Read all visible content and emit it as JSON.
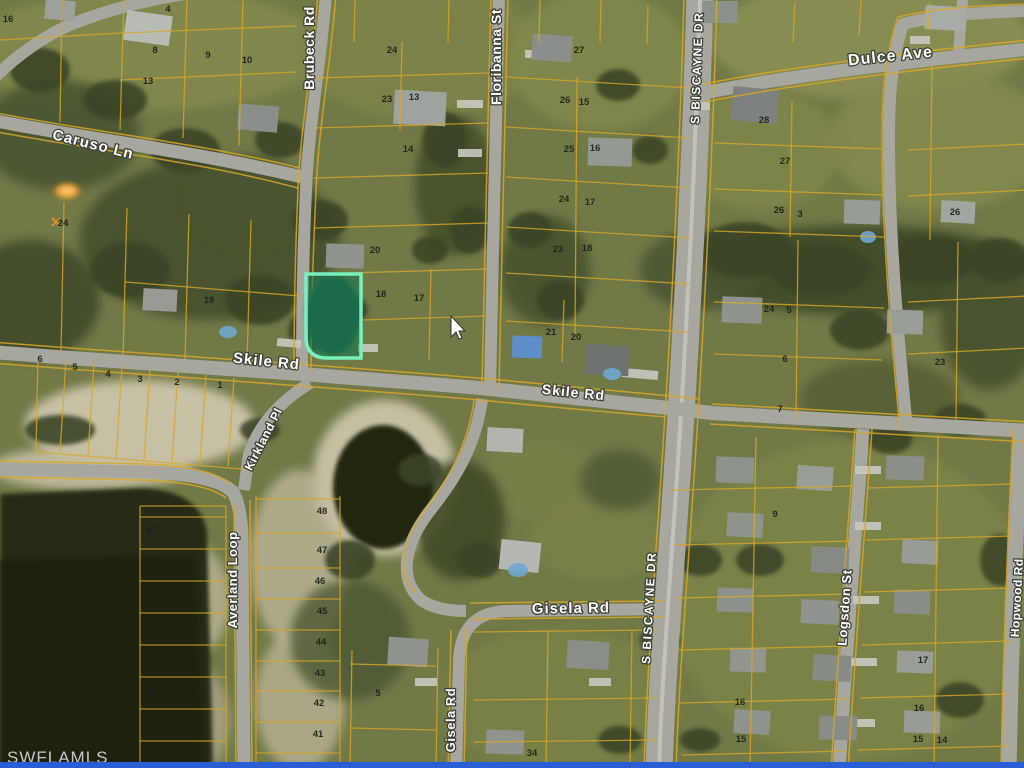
{
  "map": {
    "watermark": "SWFLAMLS",
    "colors": {
      "highlight_border": "#79efbe",
      "highlight_fill": "#0e7a52",
      "parcel_line": "#d8a728",
      "road": "#a7a7a0",
      "bottom_bar": "#2b5dd7",
      "water": "#262b13",
      "tarp_roof": "#5e8fc9"
    },
    "highlighted_parcel": {
      "label": "highlighted-lot",
      "street": "Skile Rd"
    },
    "streets": [
      {
        "id": "caruso-ln",
        "name": "Caruso Ln",
        "x": 92,
        "y": 149,
        "rot": 14,
        "size": 15,
        "ls": 1
      },
      {
        "id": "brubeck-rd",
        "name": "Brubeck Rd",
        "x": 314,
        "y": 48,
        "rot": -90,
        "size": 14,
        "ls": 0.5
      },
      {
        "id": "floribanna-st",
        "name": "Floribanna St",
        "x": 501,
        "y": 57,
        "rot": -90,
        "size": 14,
        "ls": 0.5
      },
      {
        "id": "s-biscayne-dr-n",
        "name": "S BISCAYNE DR",
        "x": 701,
        "y": 68,
        "rot": -88,
        "size": 12,
        "ls": 1.5
      },
      {
        "id": "dulce-ave",
        "name": "Dulce Ave",
        "x": 891,
        "y": 61,
        "rot": -6,
        "size": 16,
        "ls": 1
      },
      {
        "id": "skile-rd-w",
        "name": "Skile Rd",
        "x": 266,
        "y": 366,
        "rot": 6,
        "size": 15,
        "ls": 1
      },
      {
        "id": "skile-rd-e",
        "name": "Skile Rd",
        "x": 573,
        "y": 397,
        "rot": 6,
        "size": 14,
        "ls": 1
      },
      {
        "id": "kirkland-pl",
        "name": "Kirkland Pl",
        "x": 267,
        "y": 441,
        "rot": -63,
        "size": 12,
        "ls": 0.5
      },
      {
        "id": "averland-loop",
        "name": "Averland Loop",
        "x": 237,
        "y": 580,
        "rot": -90,
        "size": 13,
        "ls": 0.5
      },
      {
        "id": "s-biscayne-dr-s",
        "name": "S BISCAYNE DR",
        "x": 653,
        "y": 608,
        "rot": -87,
        "size": 12,
        "ls": 1.5
      },
      {
        "id": "gisela-rd-e",
        "name": "Gisela Rd",
        "x": 571,
        "y": 613,
        "rot": -1,
        "size": 15,
        "ls": 1
      },
      {
        "id": "gisela-rd-s",
        "name": "Gisela Rd",
        "x": 455,
        "y": 720,
        "rot": -90,
        "size": 13,
        "ls": 0.5
      },
      {
        "id": "logsdon-st",
        "name": "Logsdon St",
        "x": 849,
        "y": 608,
        "rot": -86,
        "size": 13,
        "ls": 0.5
      },
      {
        "id": "hopwood-rd",
        "name": "Hopwood Rd",
        "x": 1021,
        "y": 598,
        "rot": -87,
        "size": 12,
        "ls": 0.5
      }
    ],
    "lots": [
      {
        "n": "16",
        "x": 8,
        "y": 22
      },
      {
        "n": "4",
        "x": 168,
        "y": 12
      },
      {
        "n": "8",
        "x": 155,
        "y": 53
      },
      {
        "n": "9",
        "x": 208,
        "y": 58
      },
      {
        "n": "10",
        "x": 247,
        "y": 63
      },
      {
        "n": "13",
        "x": 148,
        "y": 84
      },
      {
        "n": "24",
        "x": 63,
        "y": 226
      },
      {
        "n": "19",
        "x": 209,
        "y": 303
      },
      {
        "n": "24",
        "x": 392,
        "y": 53
      },
      {
        "n": "23",
        "x": 387,
        "y": 102
      },
      {
        "n": "13",
        "x": 414,
        "y": 100
      },
      {
        "n": "14",
        "x": 408,
        "y": 152
      },
      {
        "n": "20",
        "x": 375,
        "y": 253
      },
      {
        "n": "18",
        "x": 381,
        "y": 297
      },
      {
        "n": "17",
        "x": 419,
        "y": 301
      },
      {
        "n": "27",
        "x": 579,
        "y": 53
      },
      {
        "n": "26",
        "x": 565,
        "y": 103
      },
      {
        "n": "15",
        "x": 584,
        "y": 105
      },
      {
        "n": "25",
        "x": 569,
        "y": 152
      },
      {
        "n": "16",
        "x": 595,
        "y": 151
      },
      {
        "n": "24",
        "x": 564,
        "y": 202
      },
      {
        "n": "17",
        "x": 590,
        "y": 205
      },
      {
        "n": "23",
        "x": 558,
        "y": 252
      },
      {
        "n": "18",
        "x": 587,
        "y": 251
      },
      {
        "n": "21",
        "x": 551,
        "y": 335
      },
      {
        "n": "20",
        "x": 576,
        "y": 340
      },
      {
        "n": "28",
        "x": 764,
        "y": 123
      },
      {
        "n": "27",
        "x": 785,
        "y": 164
      },
      {
        "n": "26",
        "x": 779,
        "y": 213
      },
      {
        "n": "3",
        "x": 800,
        "y": 217
      },
      {
        "n": "26",
        "x": 955,
        "y": 215
      },
      {
        "n": "24",
        "x": 769,
        "y": 312
      },
      {
        "n": "5",
        "x": 789,
        "y": 313
      },
      {
        "n": "6",
        "x": 785,
        "y": 362
      },
      {
        "n": "7",
        "x": 780,
        "y": 412
      },
      {
        "n": "23",
        "x": 940,
        "y": 365
      },
      {
        "n": "6",
        "x": 40,
        "y": 362
      },
      {
        "n": "5",
        "x": 75,
        "y": 370
      },
      {
        "n": "4",
        "x": 108,
        "y": 377
      },
      {
        "n": "3",
        "x": 140,
        "y": 382
      },
      {
        "n": "2",
        "x": 177,
        "y": 385
      },
      {
        "n": "1",
        "x": 220,
        "y": 388
      },
      {
        "n": "67",
        "x": 152,
        "y": 533
      },
      {
        "n": "66",
        "x": 153,
        "y": 565
      },
      {
        "n": "65",
        "x": 154,
        "y": 597
      },
      {
        "n": "64",
        "x": 153,
        "y": 630
      },
      {
        "n": "63",
        "x": 152,
        "y": 661
      },
      {
        "n": "62",
        "x": 152,
        "y": 692
      },
      {
        "n": "61",
        "x": 151,
        "y": 723
      },
      {
        "n": "60",
        "x": 151,
        "y": 755
      },
      {
        "n": "48",
        "x": 322,
        "y": 514
      },
      {
        "n": "47",
        "x": 322,
        "y": 553
      },
      {
        "n": "46",
        "x": 320,
        "y": 584
      },
      {
        "n": "45",
        "x": 322,
        "y": 614
      },
      {
        "n": "44",
        "x": 321,
        "y": 645
      },
      {
        "n": "43",
        "x": 320,
        "y": 676
      },
      {
        "n": "42",
        "x": 319,
        "y": 706
      },
      {
        "n": "41",
        "x": 318,
        "y": 737
      },
      {
        "n": "5",
        "x": 378,
        "y": 696
      },
      {
        "n": "34",
        "x": 532,
        "y": 756
      },
      {
        "n": "9",
        "x": 775,
        "y": 517
      },
      {
        "n": "17",
        "x": 923,
        "y": 663
      },
      {
        "n": "16",
        "x": 740,
        "y": 705
      },
      {
        "n": "16",
        "x": 919,
        "y": 711
      },
      {
        "n": "15",
        "x": 741,
        "y": 742
      },
      {
        "n": "15",
        "x": 918,
        "y": 742
      },
      {
        "n": "14",
        "x": 942,
        "y": 743
      }
    ]
  }
}
